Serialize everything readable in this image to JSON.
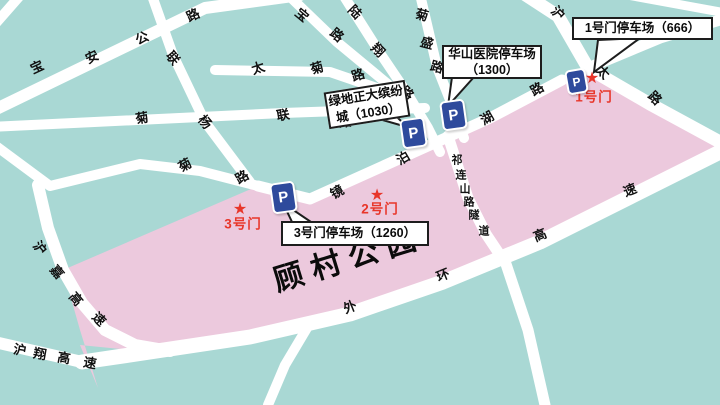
{
  "colors": {
    "background_teal": "#a9d8d4",
    "park_pink": "#ecc9dd",
    "road_white": "#ffffff",
    "parking_blue": "#2e4a9c",
    "gate_red": "#e8362a",
    "label_ink": "#111111"
  },
  "park": {
    "title": {
      "text": "顾村公园",
      "x": 348,
      "y": 256,
      "rotate": -17
    }
  },
  "road_labels": [
    {
      "name": "宝安公路",
      "size": "normal",
      "chars": [
        {
          "t": "宝",
          "x": 37,
          "y": 67,
          "r": -25
        },
        {
          "t": "安",
          "x": 92,
          "y": 57,
          "r": -25
        },
        {
          "t": "公",
          "x": 142,
          "y": 38,
          "r": -25
        },
        {
          "t": "路",
          "x": 193,
          "y": 15,
          "r": -25
        }
      ]
    },
    {
      "name": "宝安公路-东段",
      "size": "normal",
      "chars": [
        {
          "t": "宝",
          "x": 302,
          "y": 15,
          "r": 40
        },
        {
          "t": "路",
          "x": 337,
          "y": 35,
          "r": 40
        }
      ]
    },
    {
      "name": "陆翔路",
      "size": "normal",
      "chars": [
        {
          "t": "陆",
          "x": 355,
          "y": 12,
          "r": 45
        },
        {
          "t": "翔",
          "x": 378,
          "y": 50,
          "r": 45
        },
        {
          "t": "路",
          "x": 407,
          "y": 93,
          "r": 45
        }
      ]
    },
    {
      "name": "菊盛路",
      "size": "normal",
      "chars": [
        {
          "t": "菊",
          "x": 422,
          "y": 15,
          "r": 15
        },
        {
          "t": "盛",
          "x": 427,
          "y": 43,
          "r": 15
        },
        {
          "t": "路",
          "x": 437,
          "y": 67,
          "r": 15
        }
      ]
    },
    {
      "name": "太菊路",
      "size": "normal",
      "chars": [
        {
          "t": "太",
          "x": 258,
          "y": 68,
          "r": -18
        },
        {
          "t": "菊",
          "x": 317,
          "y": 68,
          "r": -18
        },
        {
          "t": "路",
          "x": 358,
          "y": 75,
          "r": -18
        }
      ]
    },
    {
      "name": "联杨路",
      "size": "normal",
      "chars": [
        {
          "t": "联",
          "x": 173,
          "y": 58,
          "r": 50
        },
        {
          "t": "杨",
          "x": 205,
          "y": 122,
          "r": 50
        }
      ]
    },
    {
      "name": "菊联路",
      "size": "normal",
      "chars": [
        {
          "t": "菊",
          "x": 142,
          "y": 118,
          "r": -10
        },
        {
          "t": "联",
          "x": 283,
          "y": 115,
          "r": -10
        },
        {
          "t": "路",
          "x": 345,
          "y": 122,
          "r": -10
        }
      ]
    },
    {
      "name": "菊路",
      "size": "normal",
      "chars": [
        {
          "t": "菊",
          "x": 185,
          "y": 165,
          "r": -30
        },
        {
          "t": "路",
          "x": 242,
          "y": 177,
          "r": -30
        }
      ]
    },
    {
      "name": "沪太路",
      "size": "normal",
      "chars": [
        {
          "t": "沪",
          "x": 558,
          "y": 13,
          "r": 45
        },
        {
          "t": "太",
          "x": 603,
          "y": 72,
          "r": 45
        },
        {
          "t": "路",
          "x": 655,
          "y": 98,
          "r": 45
        }
      ]
    },
    {
      "name": "镜泊湖路",
      "size": "normal",
      "chars": [
        {
          "t": "镜",
          "x": 337,
          "y": 192,
          "r": -30
        },
        {
          "t": "泊",
          "x": 403,
          "y": 158,
          "r": -30
        },
        {
          "t": "湖",
          "x": 487,
          "y": 118,
          "r": -30
        },
        {
          "t": "路",
          "x": 537,
          "y": 89,
          "r": -30
        }
      ]
    },
    {
      "name": "祁连山路隧道",
      "size": "small",
      "chars": [
        {
          "t": "祁",
          "x": 457,
          "y": 161,
          "r": 0
        },
        {
          "t": "连",
          "x": 461,
          "y": 176,
          "r": 0
        },
        {
          "t": "山",
          "x": 465,
          "y": 190,
          "r": 0
        },
        {
          "t": "路",
          "x": 469,
          "y": 203,
          "r": 0
        },
        {
          "t": "隧",
          "x": 474,
          "y": 216,
          "r": 0
        },
        {
          "t": "道",
          "x": 484,
          "y": 232,
          "r": 0
        }
      ]
    },
    {
      "name": "外环高速",
      "size": "normal",
      "chars": [
        {
          "t": "外",
          "x": 350,
          "y": 307,
          "r": -22
        },
        {
          "t": "环",
          "x": 443,
          "y": 275,
          "r": -22
        },
        {
          "t": "高",
          "x": 540,
          "y": 235,
          "r": -22
        },
        {
          "t": "速",
          "x": 630,
          "y": 190,
          "r": -22
        }
      ]
    },
    {
      "name": "沪嘉高速",
      "size": "normal",
      "chars": [
        {
          "t": "沪",
          "x": 40,
          "y": 248,
          "r": 50
        },
        {
          "t": "嘉",
          "x": 57,
          "y": 272,
          "r": 50
        },
        {
          "t": "高",
          "x": 76,
          "y": 299,
          "r": 50
        },
        {
          "t": "速",
          "x": 99,
          "y": 319,
          "r": 45
        }
      ]
    },
    {
      "name": "沪翔高速",
      "size": "normal",
      "chars": [
        {
          "t": "沪",
          "x": 20,
          "y": 350,
          "r": 10
        },
        {
          "t": "翔",
          "x": 40,
          "y": 354,
          "r": 10
        },
        {
          "t": "高",
          "x": 64,
          "y": 358,
          "r": 10
        },
        {
          "t": "速",
          "x": 90,
          "y": 363,
          "r": 10
        }
      ]
    }
  ],
  "gates": [
    {
      "name": "1号门",
      "star": {
        "x": 592,
        "y": 79
      },
      "label": {
        "x": 594,
        "y": 97
      }
    },
    {
      "name": "2号门",
      "star": {
        "x": 377,
        "y": 196
      },
      "label": {
        "x": 380,
        "y": 209
      }
    },
    {
      "name": "3号门",
      "star": {
        "x": 240,
        "y": 210
      },
      "label": {
        "x": 243,
        "y": 224
      }
    }
  ],
  "parking_icons": [
    {
      "id": "greenland-parking-icon",
      "glyph": "P",
      "x": 411,
      "y": 131,
      "w": 21,
      "h": 26,
      "r": -8,
      "font": 15
    },
    {
      "id": "huashan-parking-icon",
      "glyph": "P",
      "x": 451,
      "y": 113,
      "w": 21,
      "h": 26,
      "r": -8,
      "font": 15
    },
    {
      "id": "gate1-parking-icon",
      "glyph": "P",
      "x": 574,
      "y": 79,
      "w": 17,
      "h": 21,
      "r": -10,
      "font": 12
    },
    {
      "id": "gate3-parking-icon",
      "glyph": "P",
      "x": 281,
      "y": 195,
      "w": 21,
      "h": 27,
      "r": -8,
      "font": 15
    }
  ],
  "callouts": [
    {
      "id": "gate1-parking-label",
      "lines": [
        "1号门停车场（666）"
      ],
      "x": 572,
      "y": 17,
      "w": 141,
      "h": 23,
      "r": 0,
      "tail": [
        [
          598,
          40
        ],
        [
          640,
          38
        ],
        [
          594,
          72
        ]
      ]
    },
    {
      "id": "huashan-parking-label",
      "lines": [
        "华山医院停车场",
        "（1300）"
      ],
      "x": 442,
      "y": 45,
      "w": 100,
      "h": 34,
      "r": 0,
      "tail": [
        [
          452,
          77
        ],
        [
          474,
          77
        ],
        [
          448,
          106
        ]
      ]
    },
    {
      "id": "greenland-parking-label",
      "lines": [
        "绿地正大缤纷",
        "城（1030）"
      ],
      "x": 326,
      "y": 86,
      "w": 82,
      "h": 37,
      "r": -9,
      "tail": [
        [
          372,
          117
        ],
        [
          392,
          112
        ],
        [
          407,
          127
        ]
      ]
    },
    {
      "id": "gate3-parking-label",
      "lines": [
        "3号门停车场（1260）"
      ],
      "x": 281,
      "y": 221,
      "w": 148,
      "h": 25,
      "r": 0,
      "tail": [
        [
          293,
          224
        ],
        [
          314,
          224
        ],
        [
          283,
          203
        ]
      ]
    }
  ]
}
